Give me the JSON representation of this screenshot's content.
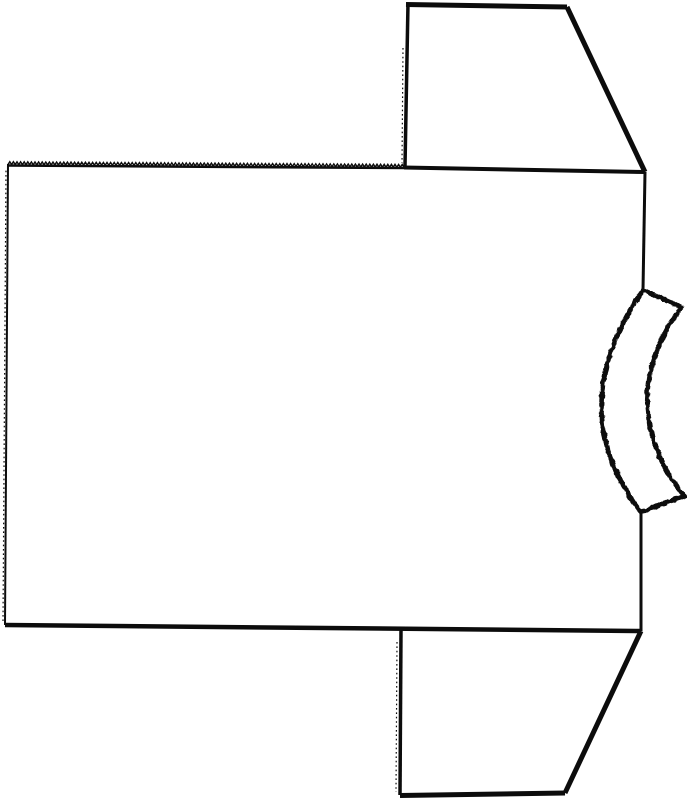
{
  "canvas": {
    "width": 687,
    "height": 800,
    "background": "#ffffff",
    "ink": "#0c0c0c"
  },
  "diagram": {
    "description": "Black-and-white outline drawing of a T-shirt sewing pattern piece laid sideways: rectangular body panel, two trapezoidal sleeves extending right, crescent neckband notch on right edge",
    "parts": {
      "body_panel": {
        "label": "body-panel",
        "shoulder_base_edge": "M8,165.5 L404,168",
        "armhole_top_edge": "M404,167.5 L645,172",
        "right_edge_upper": "M645,172 L643,290",
        "right_edge_lower": "M641,512 L641,631",
        "bottom_edge": "M641,631 L5,625",
        "left_edge": "M5,625 L8,164",
        "left_edge_texture": "M3,621 L6,168"
      },
      "top_sleeve": {
        "label": "top-sleeve",
        "left_edge": "M408,3 L405,166",
        "left_edge_texture": "M403,48 L402,163",
        "top_edge": "M406,4.5 L567,7",
        "diagonal_edge": "M567,7 L645,172"
      },
      "bottom_sleeve": {
        "label": "bottom-sleeve",
        "left_edge": "M401,630 L400,795",
        "left_edge_texture": "M397,642 L396,792",
        "bottom_edge": "M400,795.5 L565,793",
        "diagonal_edge": "M565,793 L641,631"
      },
      "neckband": {
        "label": "neckband-crescent",
        "outline": "M643,290 Q561,409 641,512 L684,496 Q612,404 681,307 Z"
      }
    },
    "serrations": {
      "shoulder_edge": {
        "x1": 8,
        "y1": 164.5,
        "x2": 404,
        "y2": 167.2,
        "pitch": 3.6,
        "amp": -2.8
      }
    }
  }
}
